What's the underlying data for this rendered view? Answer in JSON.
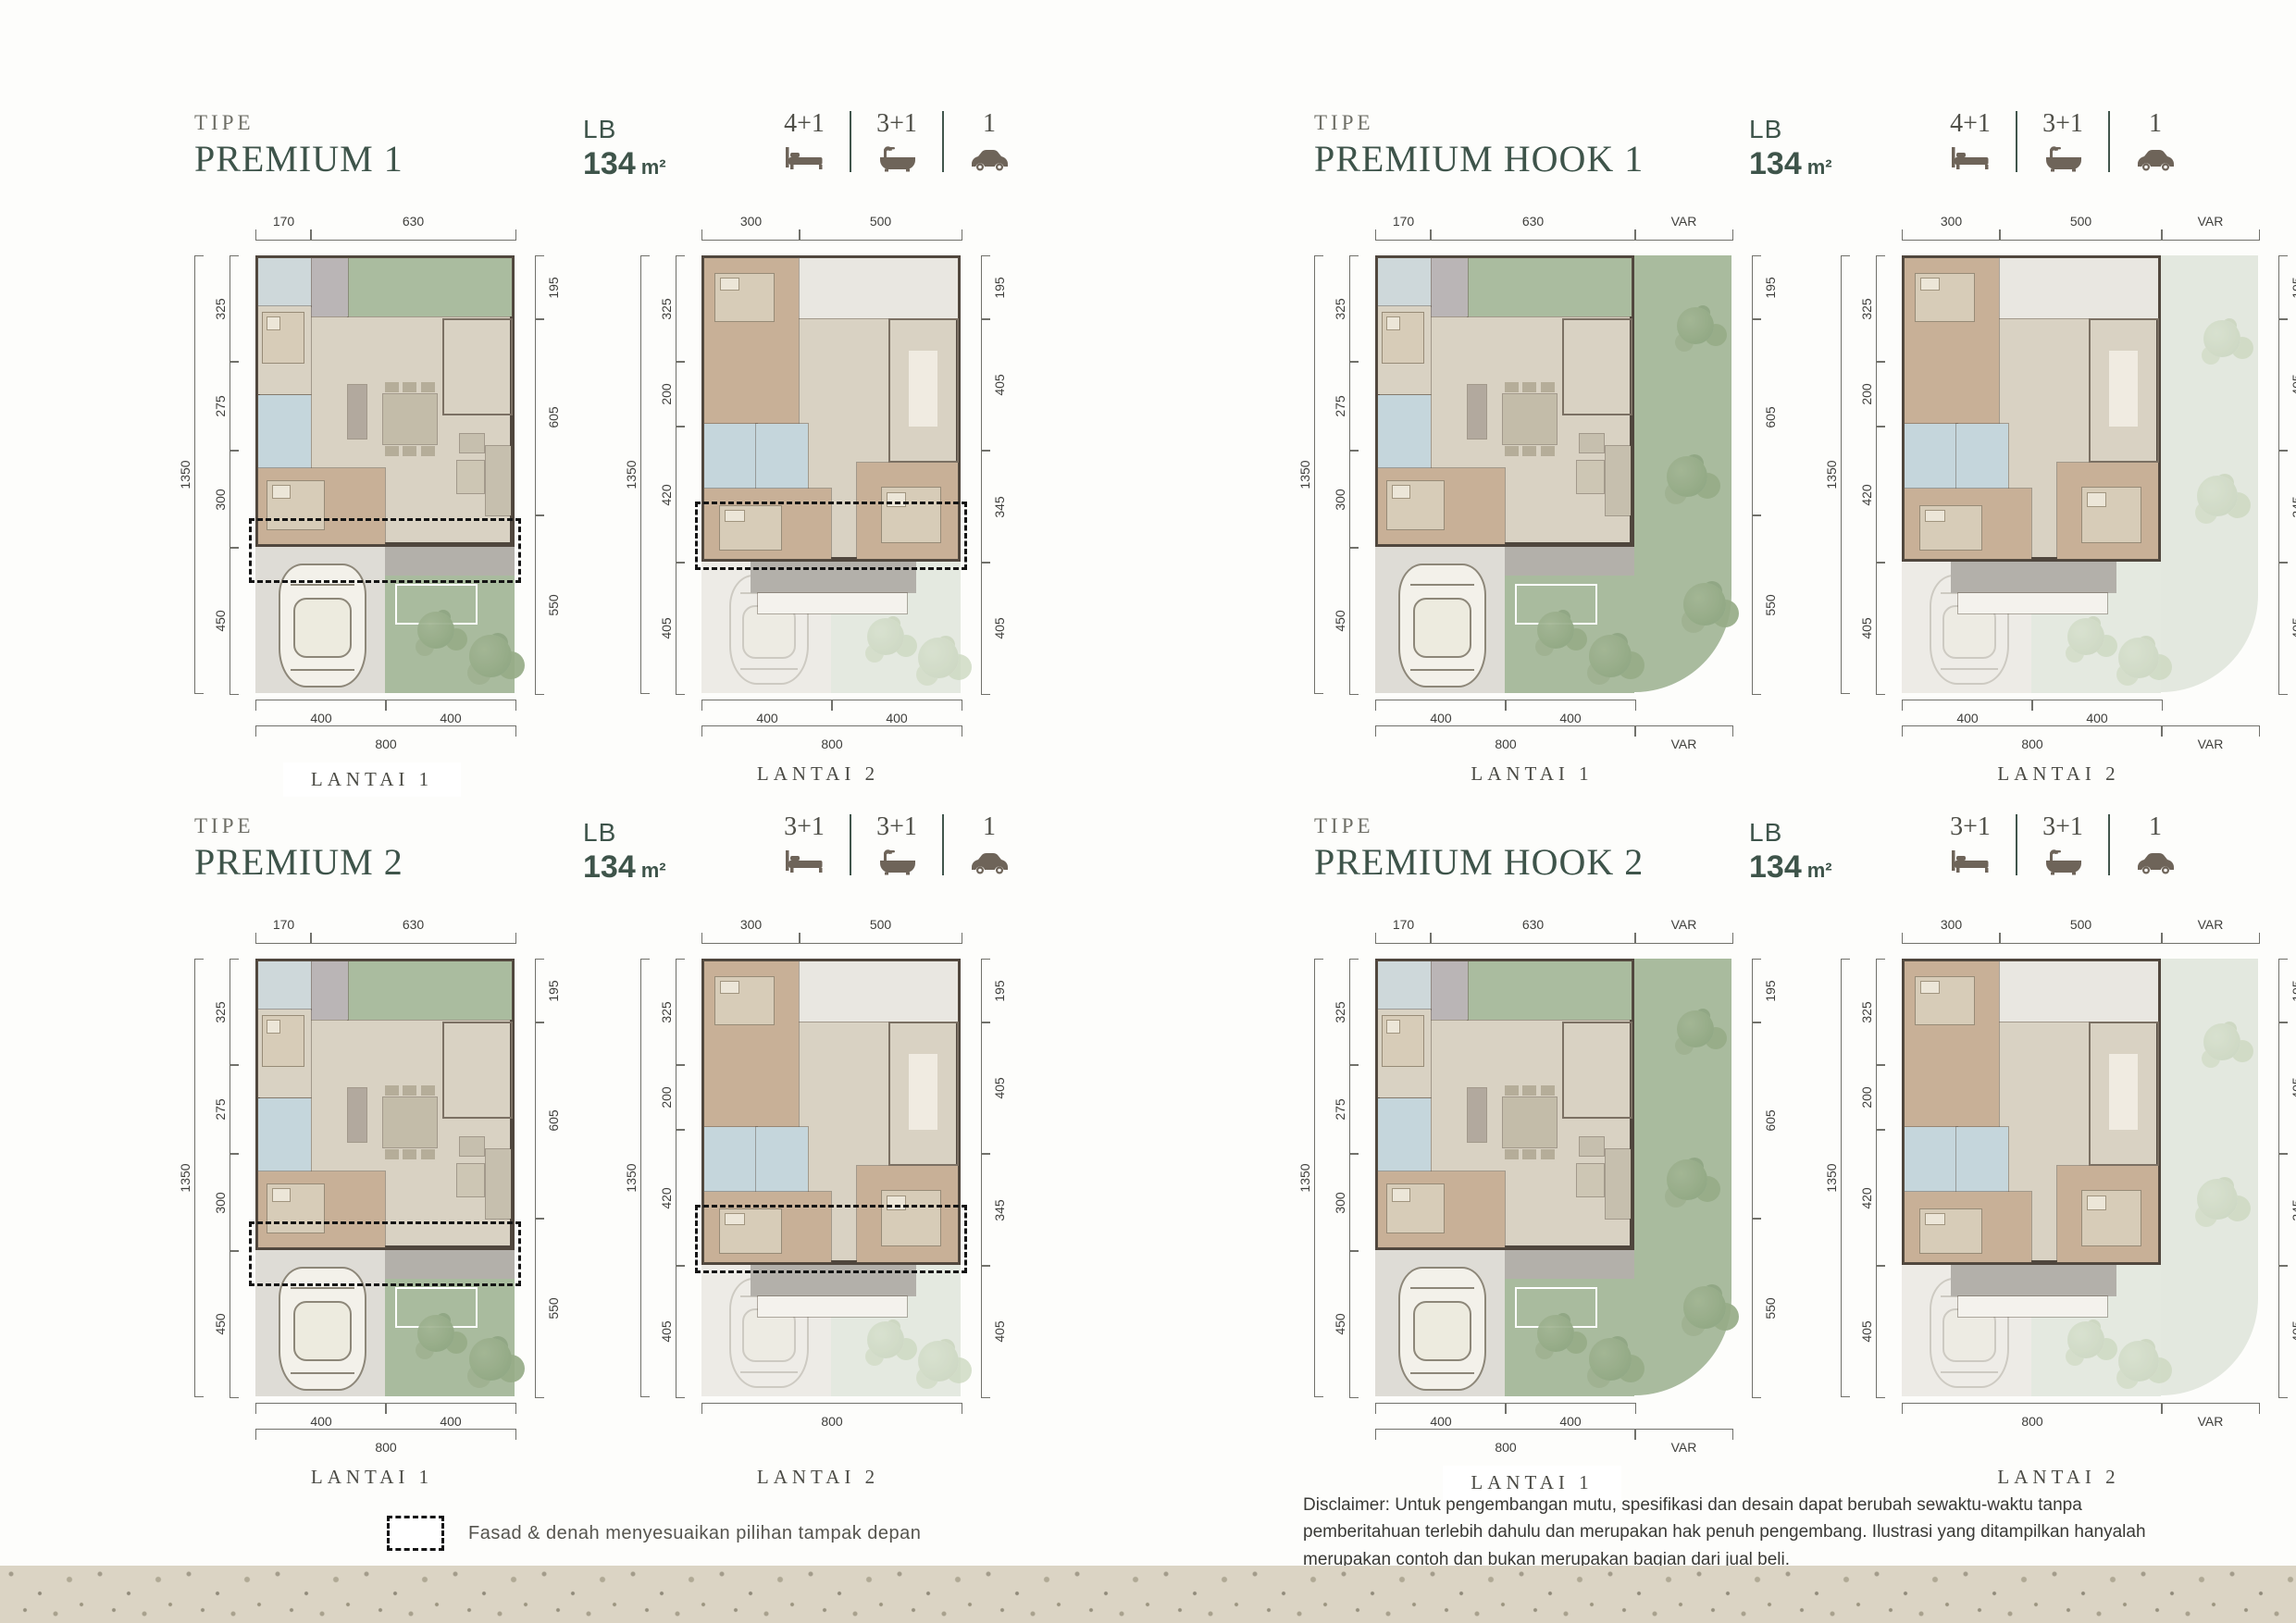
{
  "page": {
    "legend_text": "Fasad & denah menyesuaikan pilihan tampak depan",
    "disclaimer": "Disclaimer: Untuk pengembangan mutu, spesifikasi dan desain dapat berubah sewaktu-waktu tanpa pemberitahuan terlebih dahulu dan merupakan hak penuh pengembang. Ilustrasi yang ditampilkan hanyalah merupakan contoh dan bukan merupakan bagian dari jual beli."
  },
  "colors": {
    "title_green": "#3e544a",
    "icon_brown": "#6e6459",
    "garden_green": "#a9bb9e",
    "bathroom_blue": "#c5d6dc",
    "wood_floor": "#c8b097",
    "wall": "#4f463d"
  },
  "sections": [
    {
      "id": "premium-1",
      "tipe_label": "TIPE",
      "name": "PREMIUM 1",
      "lb_label": "LB",
      "lb_value": "134",
      "lb_unit": "m²",
      "stats": [
        {
          "icon": "bed-icon",
          "value": "4+1"
        },
        {
          "icon": "bath-icon",
          "value": "3+1"
        },
        {
          "icon": "car-icon",
          "value": "1"
        }
      ],
      "plans": [
        {
          "label": "LANTAI 1",
          "type": "ground",
          "hook": false,
          "fasad": true,
          "boxed": true,
          "dims": {
            "top": [
              "170",
              "630"
            ],
            "left_total": "1350",
            "left": [
              "325",
              "275",
              "300",
              "450"
            ],
            "right": [
              "195",
              "605",
              "550"
            ],
            "bottom": [
              "400",
              "400"
            ],
            "bottom_total": "800"
          }
        },
        {
          "label": "LANTAI 2",
          "type": "upper",
          "hook": false,
          "fasad": true,
          "boxed": false,
          "dims": {
            "top": [
              "300",
              "500"
            ],
            "left_total": "1350",
            "left": [
              "325",
              "200",
              "420",
              "405"
            ],
            "right": [
              "195",
              "405",
              "345",
              "405"
            ],
            "bottom": [
              "400",
              "400"
            ],
            "bottom_total": "800"
          }
        }
      ]
    },
    {
      "id": "premium-hook-1",
      "tipe_label": "TIPE",
      "name": "PREMIUM HOOK 1",
      "lb_label": "LB",
      "lb_value": "134",
      "lb_unit": "m²",
      "stats": [
        {
          "icon": "bed-icon",
          "value": "4+1"
        },
        {
          "icon": "bath-icon",
          "value": "3+1"
        },
        {
          "icon": "car-icon",
          "value": "1"
        }
      ],
      "plans": [
        {
          "label": "LANTAI 1",
          "type": "ground",
          "hook": true,
          "fasad": false,
          "boxed": false,
          "dims": {
            "top": [
              "170",
              "630"
            ],
            "top_var": "VAR",
            "left_total": "1350",
            "left": [
              "325",
              "275",
              "300",
              "450"
            ],
            "right": [
              "195",
              "605",
              "550"
            ],
            "bottom": [
              "400",
              "400"
            ],
            "bottom_total": "800",
            "bottom_var": "VAR"
          }
        },
        {
          "label": "LANTAI 2",
          "type": "upper",
          "hook": true,
          "fasad": false,
          "boxed": false,
          "dims": {
            "top": [
              "300",
              "500"
            ],
            "top_var": "VAR",
            "left_total": "1350",
            "left": [
              "325",
              "200",
              "420",
              "405"
            ],
            "right": [
              "195",
              "405",
              "345",
              "405"
            ],
            "bottom": [
              "400",
              "400"
            ],
            "bottom_total": "800",
            "bottom_var": "VAR"
          }
        }
      ]
    },
    {
      "id": "premium-2",
      "tipe_label": "TIPE",
      "name": "PREMIUM 2",
      "lb_label": "LB",
      "lb_value": "134",
      "lb_unit": "m²",
      "stats": [
        {
          "icon": "bed-icon",
          "value": "3+1"
        },
        {
          "icon": "bath-icon",
          "value": "3+1"
        },
        {
          "icon": "car-icon",
          "value": "1"
        }
      ],
      "plans": [
        {
          "label": "LANTAI 1",
          "type": "ground",
          "hook": false,
          "fasad": true,
          "boxed": false,
          "dims": {
            "top": [
              "170",
              "630"
            ],
            "left_total": "1350",
            "left": [
              "325",
              "275",
              "300",
              "450"
            ],
            "right": [
              "195",
              "605",
              "550"
            ],
            "bottom": [
              "400",
              "400"
            ],
            "bottom_total": "800"
          }
        },
        {
          "label": "LANTAI 2",
          "type": "upper",
          "hook": false,
          "fasad": true,
          "boxed": false,
          "dims": {
            "top": [
              "300",
              "500"
            ],
            "left_total": "1350",
            "left": [
              "325",
              "200",
              "420",
              "405"
            ],
            "right": [
              "195",
              "405",
              "345",
              "405"
            ],
            "bottom_total": "800"
          }
        }
      ]
    },
    {
      "id": "premium-hook-2",
      "tipe_label": "TIPE",
      "name": "PREMIUM HOOK 2",
      "lb_label": "LB",
      "lb_value": "134",
      "lb_unit": "m²",
      "stats": [
        {
          "icon": "bed-icon",
          "value": "3+1"
        },
        {
          "icon": "bath-icon",
          "value": "3+1"
        },
        {
          "icon": "car-icon",
          "value": "1"
        }
      ],
      "plans": [
        {
          "label": "LANTAI 1",
          "type": "ground",
          "hook": true,
          "fasad": false,
          "boxed": true,
          "dims": {
            "top": [
              "170",
              "630"
            ],
            "top_var": "VAR",
            "left_total": "1350",
            "left": [
              "325",
              "275",
              "300",
              "450"
            ],
            "right": [
              "195",
              "605",
              "550"
            ],
            "bottom": [
              "400",
              "400"
            ],
            "bottom_total": "800",
            "bottom_var": "VAR"
          }
        },
        {
          "label": "LANTAI 2",
          "type": "upper",
          "hook": true,
          "fasad": false,
          "boxed": false,
          "dims": {
            "top": [
              "300",
              "500"
            ],
            "top_var": "VAR",
            "left_total": "1350",
            "left": [
              "325",
              "200",
              "420",
              "405"
            ],
            "right": [
              "195",
              "405",
              "345",
              "405"
            ],
            "bottom_total": "800",
            "bottom_var": "VAR"
          }
        }
      ]
    }
  ]
}
